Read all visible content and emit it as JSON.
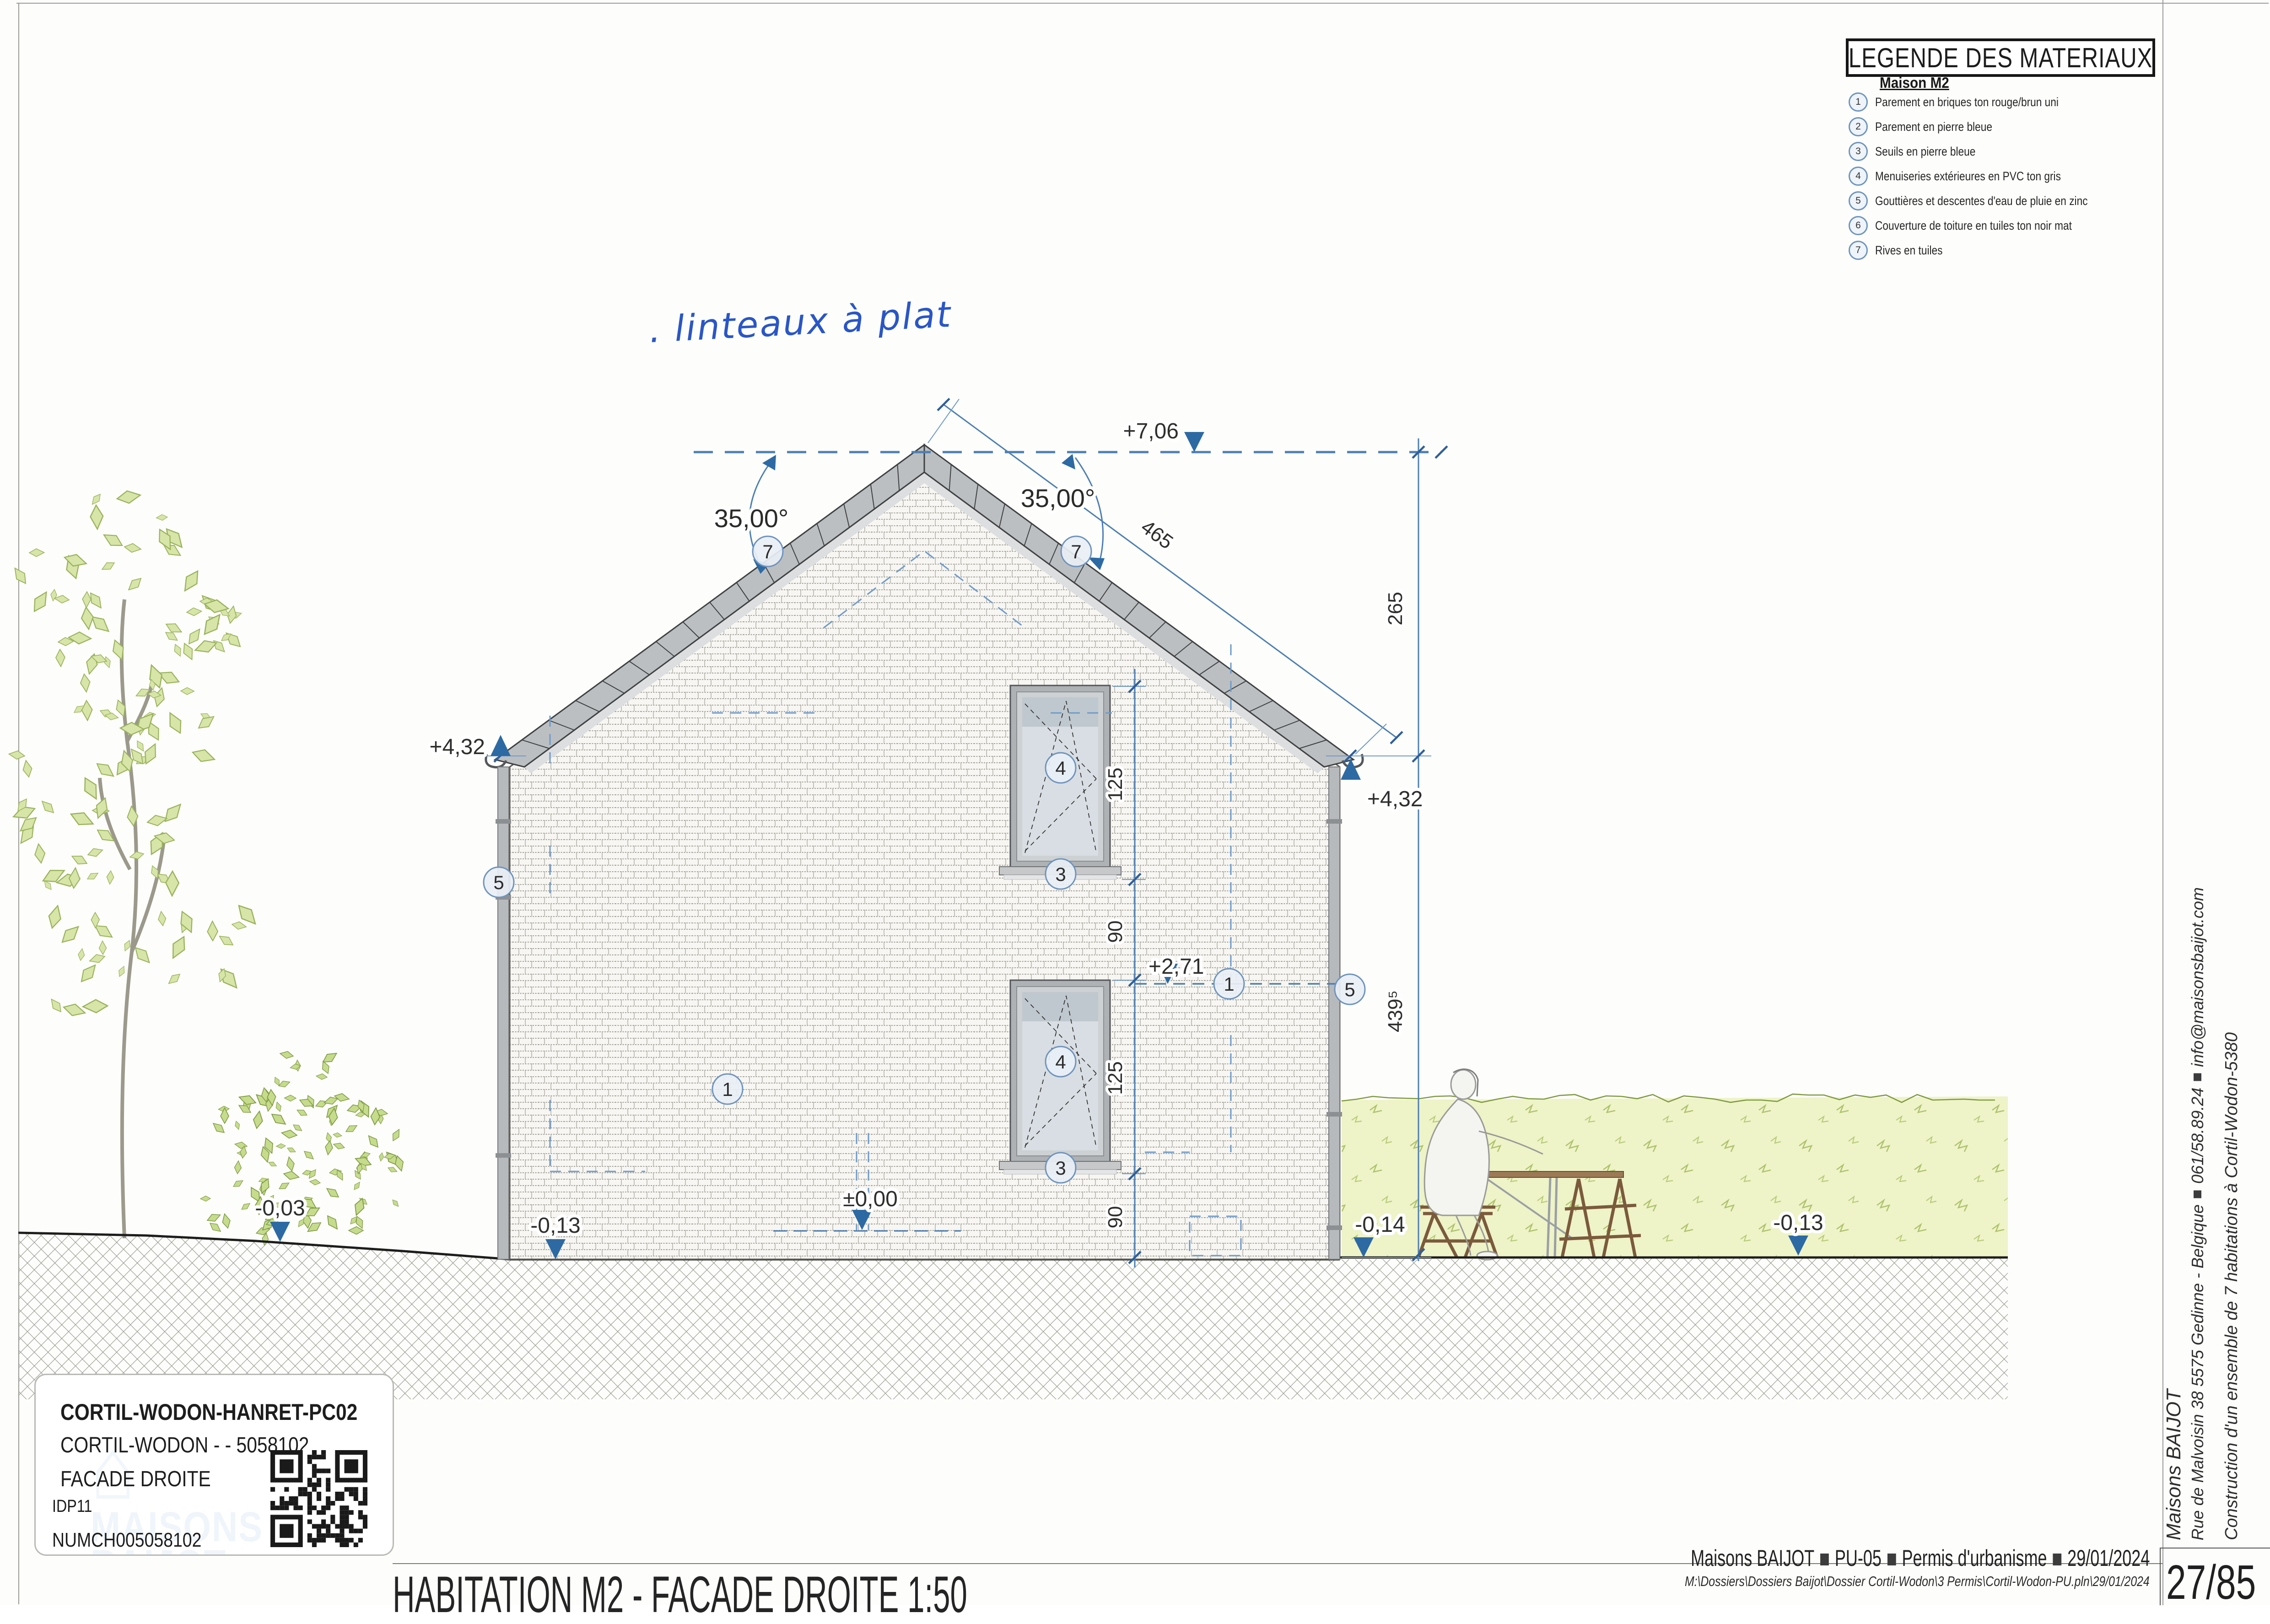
{
  "legend": {
    "title": "LEGENDE DES MATERIAUX",
    "subtitle": "Maison M2",
    "items": [
      {
        "num": "1",
        "label": "Parement en briques ton rouge/brun uni"
      },
      {
        "num": "2",
        "label": "Parement en pierre bleue"
      },
      {
        "num": "3",
        "label": "Seuils en pierre bleue"
      },
      {
        "num": "4",
        "label": "Menuiseries extérieures en PVC ton gris"
      },
      {
        "num": "5",
        "label": "Gouttières et descentes d'eau de pluie en zinc"
      },
      {
        "num": "6",
        "label": "Couverture de toiture en tuiles ton noir mat"
      },
      {
        "num": "7",
        "label": "Rives en tuiles"
      }
    ]
  },
  "annotations": {
    "handwritten": ". linteaux à plat",
    "angle_left": "35,00°",
    "angle_right": "35,00°",
    "levels": {
      "ridge": "+7,06",
      "eaves_left": "+4,32",
      "eaves_right": "+4,32",
      "floor": "+2,71",
      "zero": "±0,00",
      "ground_far_left": "-0,03",
      "base_left": "-0,13",
      "terrace_right": "-0,14",
      "ground_far_right": "-0,13"
    },
    "dims": {
      "window_height": "125",
      "spacer": "90",
      "roof_slope": "465",
      "roof_height": "265",
      "wall_height": "439⁵"
    },
    "markers": {
      "brick": "1",
      "sill": "3",
      "joinery": "4",
      "gutter": "5",
      "rives": "7"
    }
  },
  "title_block": {
    "line1": "CORTIL-WODON-HANRET-PC02",
    "line2": "CORTIL-WODON -  - 5058102",
    "line3": "FACADE DROITE",
    "idp": "IDP11",
    "num": "NUMCH005058102",
    "watermark_top": "MAISONS",
    "watermark_bottom": "BAIJOT"
  },
  "footer": {
    "title": "HABITATION M2 - FACADE DROITE 1:50",
    "company": "Maisons BAIJOT",
    "code": "PU-05",
    "doc_type": "Permis d'urbanisme",
    "date": "29/01/2024",
    "path": "M:\\Dossiers\\Dossiers Baijot\\Dossier Cortil-Wodon\\3 Permis\\Cortil-Wodon-PU.pln\\29/01/2024",
    "page": "27/85"
  },
  "side": {
    "company": "Maisons BAIJOT",
    "address": "Rue de Malvoisin 38 5575 Gedinne - Belgique",
    "phone": "061/58.89.24",
    "email": "info@maisonsbaijot.com",
    "project": "Construction d'un ensemble de 7 habitations à Cortil-Wodon-5380"
  },
  "colors": {
    "dimension_blue": "#4d7fb4",
    "level_blue": "#2d6aa3",
    "handwriting_blue": "#2a56c6",
    "hedge_green": "#eef3c8",
    "leaf_green": "#d7e5a8",
    "roof_gray": "#bcbfc1",
    "brick_bg": "#f7f6f2"
  }
}
